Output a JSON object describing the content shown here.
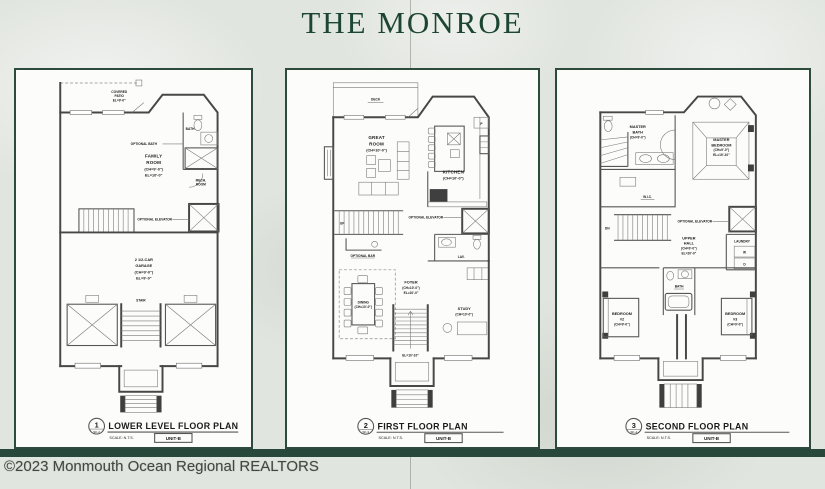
{
  "header": {
    "title": "THE MONROE"
  },
  "footer": {
    "copyright": "©2023 Monmouth Ocean Regional REALTORS"
  },
  "colors": {
    "accent_green": "#1c4632",
    "paper": "#e1e5df",
    "band_green": "#27483a"
  },
  "panels": [
    {
      "number": "1",
      "sheet": "SK-2",
      "title": "LOWER LEVEL FLOOR PLAN",
      "scale": "SCALE: N.T.S.",
      "unit": "UNIT-B",
      "labels": {
        "covered_patio": [
          "COVERED",
          "PATIO",
          "EL=9'-0\""
        ],
        "optional_bath": "OPTIONAL BATH",
        "bath": "BATH",
        "family_room": [
          "FAMILY",
          "ROOM",
          "(CH=9'-0\")",
          "EL=10'-0\""
        ],
        "mech_room": [
          "MECH.",
          "ROOM"
        ],
        "optional_elevator": "OPTIONAL ELEVATOR",
        "garage": [
          "2 1/2-CAR",
          "GARAGE",
          "(CH=9'-0\")",
          "EL=9'-0\""
        ],
        "stair": "STAIR"
      }
    },
    {
      "number": "2",
      "sheet": "SK-3",
      "title": "FIRST FLOOR PLAN",
      "scale": "SCALE: N.T.S.",
      "unit": "UNIT-B",
      "labels": {
        "deck": "DECK",
        "great_room": [
          "GREAT",
          "ROOM",
          "(CH=10'-0\")"
        ],
        "kitchen": [
          "KITCHEN",
          "(CH=10'-0\")"
        ],
        "pantry": "P",
        "optional_elevator": "OPTIONAL ELEVATOR",
        "optional_bar": "OPTIONAL BAR",
        "dining": [
          "DINING",
          "(CH=10'-0\")"
        ],
        "foyer": [
          "FOYER",
          "(CH=10'-0\")",
          "EL=10'-0\""
        ],
        "lav": "LAV.",
        "study": [
          "STUDY",
          "(CH=10'-0\")"
        ],
        "stair_el": "EL=10'-10\"",
        "up": "UP"
      }
    },
    {
      "number": "3",
      "sheet": "SK-4",
      "title": "SECOND FLOOR PLAN",
      "scale": "SCALE: N.T.S.",
      "unit": "UNIT-B",
      "labels": {
        "master_bath": [
          "MASTER",
          "BATH",
          "(CH=9'-0\")"
        ],
        "master_bedroom": [
          "MASTER",
          "BEDROOM",
          "(CH=9'-0\")",
          "EL=19'-10\""
        ],
        "wic": "W.I.C.",
        "optional_elevator": "OPTIONAL ELEVATOR",
        "upper_hall": [
          "UPPER",
          "HALL",
          "(CH=9'-0\")",
          "EL=20'-0\""
        ],
        "laundry": "LAUNDRY",
        "washer": "W",
        "dryer": "D",
        "bath": "BATH",
        "bedroom2": [
          "BEDROOM",
          "#2",
          "(CH=9'-0\")"
        ],
        "bedroom3": [
          "BEDROOM",
          "#3",
          "(CH=9'-0\")"
        ],
        "dn": "DN"
      }
    }
  ]
}
